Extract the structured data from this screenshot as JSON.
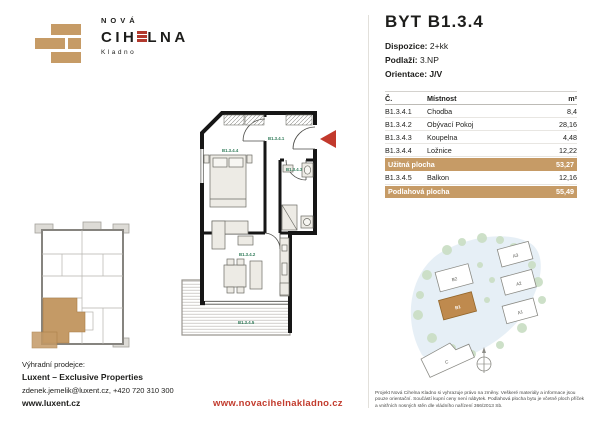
{
  "brand": {
    "top": "NOVÁ",
    "main_left": "CIH",
    "main_right": "LNA",
    "main_full": "CIHELNA",
    "sub": "Kladno"
  },
  "header": {
    "title": "BYT B1.3.4",
    "specs": [
      {
        "label": "Dispozice:",
        "value": "2+kk"
      },
      {
        "label": "Podlaží:",
        "value": "3.NP"
      },
      {
        "label": "Orientace:",
        "value": "J/V"
      }
    ]
  },
  "table": {
    "col_code": "Č.",
    "col_room": "Místnost",
    "col_area": "m²",
    "rows": [
      {
        "code": "B1.3.4.1",
        "room": "Chodba",
        "area": "8,4"
      },
      {
        "code": "B1.3.4.2",
        "room": "Obývací Pokoj",
        "area": "28,16"
      },
      {
        "code": "B1.3.4.3",
        "room": "Koupelna",
        "area": "4,48"
      },
      {
        "code": "B1.3.4.4",
        "room": "Ložnice",
        "area": "12,22"
      }
    ],
    "subtotal": {
      "label": "Užitná plocha",
      "area": "53,27"
    },
    "balcony_row": {
      "code": "B1.3.4.5",
      "room": "Balkon",
      "area": "12,16"
    },
    "total": {
      "label": "Podlahová plocha",
      "area": "55,49"
    }
  },
  "floorplan": {
    "labels": {
      "hall": "B1.3.4.1",
      "living": "B1.3.4.2",
      "bath": "B1.3.4.3",
      "bedroom": "B1.3.4.4",
      "balcony": "B1.3.4.5"
    }
  },
  "siteplan": {
    "labels": {
      "b2": "B2",
      "b1": "B1",
      "a3": "A3",
      "a2": "A2",
      "a1": "A1",
      "c": "C"
    },
    "highlighted": "B1"
  },
  "footer": {
    "seller_label": "Výhradní prodejce:",
    "seller_name": "Luxent – Exclusive Properties",
    "seller_contact": "zdenek.jemelik@luxent.cz, +420 720 310 300",
    "seller_web": "www.luxent.cz",
    "project_web": "www.novacihelnakladno.cz",
    "disclaimer": "Projekt Nová Cihelna Kladno si vyhrazuje právo na změny. Veškeré materiály a informace jsou pouze orientační. Součástí kupní ceny není nábytek. Podlahová plocha bytu je včetně ploch příček a vnitřních nosných stěn dle vládního nařízení 366/2013 Sb."
  },
  "colors": {
    "brick": "#C69B66",
    "accent_red": "#BC3B2D",
    "plan_label_green": "#2F7A58"
  }
}
